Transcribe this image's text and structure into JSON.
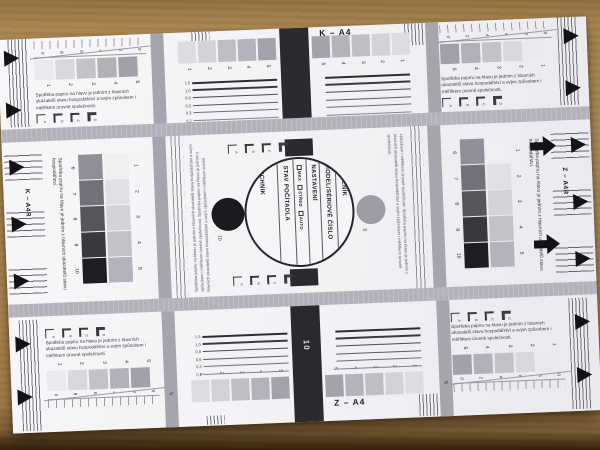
{
  "scene": {
    "description": "Photograph of a printed copier/printer test sheet lying on brown cardboard",
    "cardboard_color": "#b08a55",
    "shadow_color": "#4a351a",
    "paper_color": "#f4f4f6"
  },
  "labels": {
    "top_center": "K – A4",
    "bottom_center": "Z – A4",
    "left_edge": "K – A4R",
    "right_edge": "Z – A4R",
    "bar_number": "10",
    "black_dot_number": "10",
    "gray_dot_number": "5",
    "left_bar_number": "5",
    "right_bar_number": "5"
  },
  "circle_form": {
    "customer": "ZÁKAZNÍK",
    "model": "MODEL/SÉRIOVÉ ČÍSLO",
    "settings": "NASTAVENÍ",
    "options": [
      "MAX",
      "STŘED",
      "AUTO"
    ],
    "counter": "STAV POČÍTADLA",
    "technician": "TECHNIK"
  },
  "passages": {
    "corner": "Spotřeba papíru na hlavu je jedním z hlavních ukazatelů stavu hospodářství a svým způsobem i měřítkem úrovně společnosti.",
    "side": "Spotřeba papíru na hlavu je jedním z hlavních ukazatelů stavu hospodářství.",
    "fine_print": "Spotřeba papíru na hlavu je jedním z hlavních ukazatelů stavu hospodářství a svým způsobem i měřítkem úrovně společnosti. Spotřeba papíru na hlavu je jedním z hlavních ukazatelů stavu hospodářství a svým způsobem i měřítkem úrovně společnosti."
  },
  "scales": {
    "one_to_five": [
      "1",
      "2",
      "3",
      "4",
      "5"
    ],
    "five_to_one": [
      "5",
      "4",
      "3",
      "2",
      "1"
    ],
    "six_to_ten": [
      "6",
      "7",
      "8",
      "9",
      "10"
    ],
    "line_widths": [
      "1.5",
      "1.0",
      "0.8",
      "0.5",
      "0.3",
      "0.2"
    ],
    "diagonal_left": [
      "0",
      "8",
      "6",
      "4",
      "2",
      "0"
    ],
    "diagonal_right": [
      "0",
      "2",
      "4",
      "6",
      "8",
      "0"
    ],
    "bracket_letters": [
      "A",
      "B",
      "C",
      "D"
    ]
  },
  "swatches": {
    "corner_light_to_dark": [
      "#e9eaee",
      "#d8d9dd",
      "#c2c3c9",
      "#b0b1b9",
      "#a0a1a9"
    ],
    "corner_dark_to_light": [
      "#a0a1a9",
      "#b0b1b9",
      "#c2c3c9",
      "#d8d9dd",
      "#e9eaee"
    ],
    "center_left": [
      "#dcdde1",
      "#d2d3d7",
      "#bebfc5",
      "#b2b3bb",
      "#a2a3ab"
    ],
    "center_right": [
      "#a2a3ab",
      "#b2b3bb",
      "#bebfc5",
      "#d2d3d7",
      "#dcdde1"
    ],
    "vertical_dark": [
      "#8e8f97",
      "#717279",
      "#55565c",
      "#38383e",
      "#1e1e22"
    ],
    "vertical_light": [
      "#eeeff1",
      "#e0e1e5",
      "#d2d3d9",
      "#c2c3c9",
      "#b2b3bb"
    ]
  },
  "colors": {
    "band": "#b2b3ba",
    "column_bar": "#a4a5ad",
    "black_bar": "#2a2a2e",
    "arrow": "#131316",
    "circle_outline": "#26262a",
    "gray_dot": "#9b9ca4",
    "black_dot": "#1b1b1f"
  }
}
